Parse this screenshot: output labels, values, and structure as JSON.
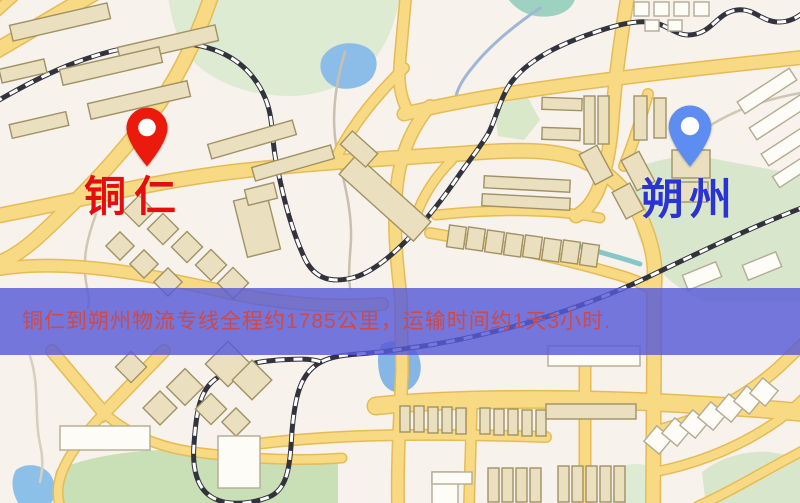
{
  "banner": {
    "text": "铜仁到朔州物流专线全程约1785公里，运输时间约1天3小时.",
    "bg": "rgba(88,90,216,0.82)",
    "text_color": "#cc4a4a"
  },
  "markers": [
    {
      "name": "tongren",
      "label": "铜仁",
      "pin_color": "#ea1b0c",
      "text_color": "#e60d0d"
    },
    {
      "name": "shuozhou",
      "label": "朔州",
      "pin_color": "#5d8df1",
      "text_color": "#2a33d4"
    }
  ],
  "map": {
    "style": {
      "bg": "#f7f2ec",
      "road_fill": "#f8da85",
      "road_casing": "#e6bb55",
      "rail_dark": "#33333d",
      "rail_light": "#ffffff",
      "tan_fill": "#eae0bf",
      "tan_stroke": "#a09265",
      "white_fill": "#fdfcf7",
      "white_stroke": "#b3ab93"
    },
    "parks": [
      [
        "M 168 -4 L 400 -4 C 396 20 388 44 372 62 C 352 84 320 96 290 96 C 255 96 220 86 196 64 C 180 50 172 24 168 -4 Z",
        "#dcebd2"
      ],
      [
        "M 506 -4 L 576 -4 C 574 6 566 14 552 16 C 534 19 516 12 506 -4 Z",
        "#9ed2c0"
      ],
      [
        "M 494 104 L 528 98 L 540 120 L 524 140 L 498 136 Z",
        "#d9e8c9"
      ],
      [
        "M 636 168 C 660 158 686 154 710 158 L 806 176 L 806 302 L 706 302 C 676 290 652 268 640 240 C 632 220 630 190 636 168 Z",
        "#d8e7cc"
      ],
      [
        "M 56 470 C 100 452 160 446 220 452 C 270 457 310 458 338 462 L 338 506 L 60 506 C 54 494 53 482 56 470 Z",
        "#c9dfb6"
      ],
      [
        "M 702 472 C 720 458 744 450 770 452 L 806 458 L 806 506 L 706 506 Z",
        "#d8e7cc"
      ],
      [
        "M 614 470 C 628 462 644 462 656 470 L 660 506 L 612 506 Z",
        "#dcebd2"
      ]
    ],
    "water": [
      [
        "M 322 58 C 330 44 348 40 364 46 C 378 52 380 66 372 78 C 362 90 340 92 330 84 C 322 78 318 68 322 58 Z",
        "#8cbde8"
      ],
      [
        "M 382 344 C 396 338 412 342 418 354 C 424 368 420 384 408 390 C 396 396 384 390 380 376 C 377 364 377 352 382 344 Z",
        "#86b6e6"
      ],
      [
        "M 16 470 C 26 462 42 464 50 474 C 58 486 56 500 48 506 L 20 506 C 12 494 10 480 16 470 Z",
        "#8cc0e8"
      ]
    ],
    "streams": [
      [
        "M 540 8 C 515 25 490 45 472 68 C 462 80 458 88 456 96",
        "#9fb6d6",
        3
      ],
      [
        "M 345 52 C 335 85 330 120 338 155 C 344 182 352 210 351 240 C 350 258 348 272 350 288",
        "#c9c1ae",
        2.5
      ],
      [
        "M 96 214 C 88 236 82 258 86 282 C 88 294 90 300 88 308",
        "#cfc7b4",
        2.5
      ],
      [
        "M 30 356 C 40 386 34 416 40 444 C 44 462 42 472 40 482",
        "#d6cfbf",
        2.5
      ],
      [
        "M 578 246 C 600 252 622 258 640 264",
        "#86c8c8",
        5
      ],
      [
        "M 806 92 C 770 98 740 108 716 122 C 700 131 690 142 684 154",
        "#cfc7b4",
        2.5
      ]
    ],
    "roads": [
      [
        "M -6 52 L 96 -8",
        14
      ],
      [
        "M 16 -6 L -6 14",
        9
      ],
      [
        "M 212 -6 C 196 42 176 82 150 116 C 124 150 96 182 62 214 C 36 240 18 256 -4 264",
        13
      ],
      [
        "M -6 270 C 60 258 140 272 226 292 C 282 304 335 308 382 304",
        11
      ],
      [
        "M -4 216 C 90 198 160 180 240 171 C 320 162 400 158 470 153 C 520 149 552 150 576 158 C 610 170 634 196 646 230 C 654 252 656 268 654 292 L 654 360 C 654 410 653 460 653 506",
        13
      ],
      [
        "M 436 215 C 500 208 560 210 600 218",
        8
      ],
      [
        "M 430 233 C 495 244 565 259 622 276 C 638 281 648 286 654 292",
        9
      ],
      [
        "M 404 114 C 470 98 540 88 620 78 C 700 68 762 62 806 57",
        12
      ],
      [
        "M 628 -6 C 622 30 616 70 613 110 C 611 140 608 165 598 190 C 592 204 584 212 576 216",
        12
      ],
      [
        "M 430 106 C 408 132 398 162 396 196 C 393 236 398 270 401 300 L 402 370 C 400 420 397 460 398 506",
        11
      ],
      [
        "M 406 -6 L 400 60 C 398 82 400 96 408 112",
        10
      ],
      [
        "M 404 68 C 378 94 354 122 338 154",
        9
      ],
      [
        "M 452 160 C 434 178 423 196 416 216",
        8
      ],
      [
        "M 376 406 C 450 398 560 398 650 402 C 722 406 772 409 806 413",
        16
      ],
      [
        "M 256 444 C 340 434 430 433 546 437",
        9
      ],
      [
        "M 472 402 L 469 506",
        9
      ],
      [
        "M 585 358 L 585 506",
        10
      ],
      [
        "M 652 432 C 700 421 742 400 778 368 C 792 355 800 347 806 341",
        10
      ],
      [
        "M 655 472 C 700 463 742 446 780 419 C 793 409 800 402 806 396",
        8
      ],
      [
        "M 698 506 C 730 492 762 472 806 449",
        8
      ],
      [
        "M 52 351 L 104 413 L 164 351",
        11
      ],
      [
        "M 104 413 C 130 436 162 449 202 453 C 252 459 302 461 342 458",
        8
      ],
      [
        "M 104 413 C 86 432 70 452 62 472 C 57 486 57 496 60 506",
        8
      ],
      [
        "M 648 94 C 641 118 634 142 624 166",
        9
      ]
    ],
    "railways": [
      [
        "M -6 103 C 40 76 92 50 152 44 C 212 38 250 60 266 100 C 274 121 271 140 277 166 C 284 202 294 236 305 259 C 315 279 331 283 352 278 C 381 271 420 231 455 181 C 470 159 479 149 488 134 C 496 120 500 96 513 80 C 531 58 561 44 593 33 C 616 25 641 18 659 24 C 673 29 680 38 696 34 C 713 30 719 12 737 10 C 755 8 761 22 779 22 C 793 22 801 14 807 10"
      ],
      [
        "M 807 206 C 758 224 700 252 648 277 C 598 301 540 321 488 333 C 448 343 418 347 388 351 C 360 355 338 353 321 362 C 300 373 295 397 292 431 C 290 466 288 489 269 497 C 249 505 224 506 210 496 C 197 487 192 468 194 444 C 196 415 199 394 212 382 C 227 368 252 362 278 360 C 295 359 310 358 321 362"
      ]
    ],
    "buildings": [
      [
        10,
        14,
        100,
        16,
        -13,
        "t"
      ],
      [
        118,
        36,
        100,
        16,
        -13,
        "t"
      ],
      [
        60,
        58,
        102,
        16,
        -13,
        "t"
      ],
      [
        0,
        64,
        46,
        14,
        -13,
        "t"
      ],
      [
        88,
        92,
        102,
        16,
        -13,
        "t"
      ],
      [
        10,
        118,
        58,
        14,
        -13,
        "t"
      ],
      [
        208,
        132,
        88,
        15,
        -16,
        "t"
      ],
      [
        252,
        156,
        82,
        14,
        -16,
        "t"
      ],
      [
        128,
        200,
        22,
        22,
        45,
        "t"
      ],
      [
        152,
        218,
        22,
        22,
        45,
        "t"
      ],
      [
        176,
        236,
        22,
        22,
        45,
        "t"
      ],
      [
        200,
        254,
        22,
        22,
        45,
        "t"
      ],
      [
        222,
        272,
        22,
        22,
        45,
        "t"
      ],
      [
        110,
        236,
        20,
        20,
        45,
        "t"
      ],
      [
        134,
        254,
        20,
        20,
        45,
        "t"
      ],
      [
        158,
        272,
        20,
        20,
        45,
        "t"
      ],
      [
        240,
        196,
        34,
        58,
        -14,
        "t"
      ],
      [
        246,
        186,
        30,
        16,
        -14,
        "t"
      ],
      [
        335,
        185,
        100,
        26,
        42,
        "t"
      ],
      [
        342,
        140,
        34,
        18,
        42,
        "t"
      ],
      [
        448,
        226,
        17,
        22,
        8,
        "t"
      ],
      [
        467,
        228,
        17,
        22,
        8,
        "t"
      ],
      [
        486,
        231,
        17,
        22,
        8,
        "t"
      ],
      [
        505,
        234,
        17,
        22,
        8,
        "t"
      ],
      [
        524,
        236,
        17,
        22,
        8,
        "t"
      ],
      [
        543,
        239,
        17,
        22,
        8,
        "t"
      ],
      [
        562,
        241,
        17,
        22,
        8,
        "t"
      ],
      [
        581,
        244,
        17,
        22,
        8,
        "t"
      ],
      [
        484,
        178,
        86,
        12,
        3,
        "t"
      ],
      [
        482,
        196,
        88,
        12,
        3,
        "t"
      ],
      [
        542,
        98,
        40,
        12,
        2,
        "t"
      ],
      [
        542,
        128,
        38,
        12,
        2,
        "t"
      ],
      [
        584,
        96,
        11,
        48,
        0,
        "t"
      ],
      [
        598,
        96,
        11,
        48,
        0,
        "t"
      ],
      [
        634,
        2,
        15,
        14,
        0,
        "w"
      ],
      [
        654,
        2,
        15,
        14,
        0,
        "w"
      ],
      [
        674,
        2,
        15,
        14,
        0,
        "w"
      ],
      [
        694,
        2,
        15,
        14,
        0,
        "w"
      ],
      [
        645,
        20,
        14,
        11,
        0,
        "w"
      ],
      [
        668,
        20,
        14,
        11,
        0,
        "w"
      ],
      [
        736,
        84,
        62,
        14,
        -33,
        "w"
      ],
      [
        748,
        110,
        62,
        14,
        -33,
        "w"
      ],
      [
        760,
        136,
        62,
        14,
        -33,
        "w"
      ],
      [
        772,
        162,
        50,
        13,
        -33,
        "w"
      ],
      [
        672,
        150,
        38,
        28,
        0,
        "t"
      ],
      [
        674,
        182,
        34,
        20,
        0,
        "t"
      ],
      [
        586,
        148,
        20,
        34,
        -28,
        "t"
      ],
      [
        628,
        154,
        20,
        34,
        -28,
        "t"
      ],
      [
        618,
        186,
        20,
        30,
        -28,
        "t"
      ],
      [
        634,
        96,
        13,
        44,
        0,
        "t"
      ],
      [
        654,
        98,
        12,
        40,
        0,
        "t"
      ],
      [
        684,
        268,
        36,
        16,
        -22,
        "w"
      ],
      [
        744,
        258,
        36,
        16,
        -22,
        "w"
      ],
      [
        212,
        348,
        32,
        32,
        45,
        "t"
      ],
      [
        238,
        366,
        28,
        28,
        45,
        "t"
      ],
      [
        172,
        374,
        26,
        26,
        45,
        "t"
      ],
      [
        148,
        396,
        24,
        24,
        45,
        "t"
      ],
      [
        200,
        398,
        22,
        22,
        45,
        "t"
      ],
      [
        226,
        412,
        20,
        20,
        45,
        "t"
      ],
      [
        120,
        356,
        22,
        22,
        45,
        "t"
      ],
      [
        60,
        426,
        90,
        24,
        0,
        "w"
      ],
      [
        218,
        436,
        42,
        52,
        0,
        "w"
      ],
      [
        400,
        406,
        10,
        26,
        0,
        "t"
      ],
      [
        414,
        406,
        10,
        26,
        0,
        "t"
      ],
      [
        428,
        407,
        10,
        26,
        0,
        "t"
      ],
      [
        442,
        407,
        10,
        26,
        0,
        "t"
      ],
      [
        456,
        408,
        10,
        26,
        0,
        "t"
      ],
      [
        480,
        408,
        10,
        26,
        0,
        "t"
      ],
      [
        494,
        409,
        10,
        26,
        0,
        "t"
      ],
      [
        508,
        409,
        10,
        26,
        0,
        "t"
      ],
      [
        522,
        410,
        10,
        26,
        0,
        "t"
      ],
      [
        536,
        410,
        10,
        26,
        0,
        "t"
      ],
      [
        546,
        404,
        90,
        15,
        0,
        "t"
      ],
      [
        548,
        346,
        92,
        20,
        0,
        "w"
      ],
      [
        488,
        468,
        11,
        34,
        0,
        "t"
      ],
      [
        502,
        468,
        11,
        34,
        0,
        "t"
      ],
      [
        516,
        468,
        11,
        34,
        0,
        "t"
      ],
      [
        530,
        468,
        11,
        34,
        0,
        "t"
      ],
      [
        558,
        466,
        11,
        36,
        0,
        "t"
      ],
      [
        572,
        466,
        11,
        36,
        0,
        "t"
      ],
      [
        586,
        466,
        11,
        36,
        0,
        "t"
      ],
      [
        600,
        466,
        11,
        36,
        0,
        "t"
      ],
      [
        614,
        466,
        11,
        36,
        0,
        "t"
      ],
      [
        432,
        472,
        26,
        32,
        0,
        "w"
      ],
      [
        432,
        472,
        40,
        12,
        0,
        "w"
      ],
      [
        648,
        430,
        20,
        20,
        40,
        "w"
      ],
      [
        666,
        422,
        20,
        20,
        40,
        "w"
      ],
      [
        684,
        414,
        20,
        20,
        40,
        "w"
      ],
      [
        702,
        406,
        20,
        20,
        40,
        "w"
      ],
      [
        720,
        398,
        20,
        20,
        40,
        "w"
      ],
      [
        738,
        390,
        20,
        20,
        40,
        "w"
      ],
      [
        754,
        382,
        20,
        20,
        40,
        "w"
      ]
    ]
  }
}
